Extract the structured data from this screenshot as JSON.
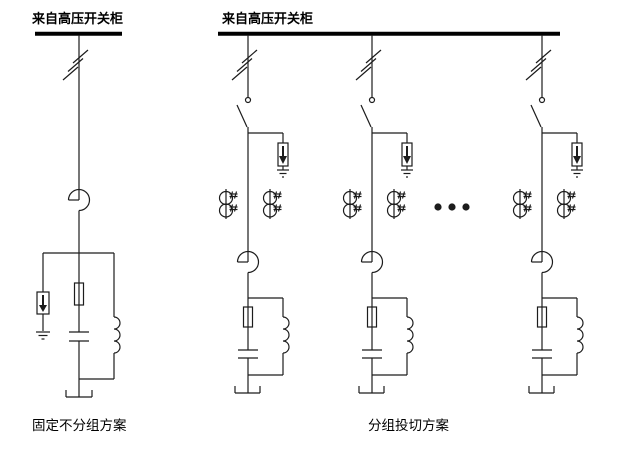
{
  "colors": {
    "background": "#ffffff",
    "line": "#1c1c1c",
    "text": "#000000"
  },
  "left_scheme": {
    "source_label": "来自高压开关柜",
    "caption": "固定不分组方案"
  },
  "right_scheme": {
    "source_label": "来自高压开关柜",
    "caption": "分组投切方案",
    "feeders_shown": 3,
    "continuation": "ellipsis-dots"
  },
  "symbols": {
    "busbar": "thick horizontal bar",
    "phase-slashes": "three diagonal tick marks on conductor",
    "disconnector-switch": "small circle with blade line",
    "surge-arrester": "box with filled down-arrow to earth",
    "earth": "three shrinking horizontal bars",
    "discharge-coil": "two stacked circles with hash marks",
    "current-transformer": "circle with chord and through conductor",
    "fuse": "narrow rectangle on conductor",
    "capacitor": "two parallel plates",
    "series-reactor": "three right-bulging humps",
    "frame-terminal": "upward open bracket",
    "ellipsis-dots": "three filled dots"
  }
}
